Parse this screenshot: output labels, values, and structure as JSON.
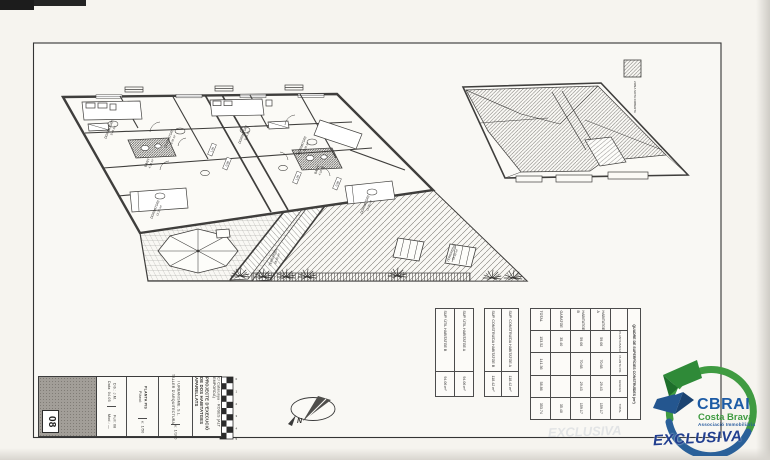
{
  "sheet": {
    "number": "08",
    "project_title": "PROJECTE D'EXECUCIÓ DE DOS HABITATGES APARELLATS",
    "project_address": "C/ Catalunya · ROSES (ALT EMPORDÀ)",
    "firm_line1": "TALLER D'ARQUITECTURA",
    "firm_line2": "I URBANISME, S.L.",
    "drawing_label": "Plànol:",
    "drawing_name": "PLANTA PIS",
    "scale_a": "e: 1/50",
    "scale_b": "e: 1/100",
    "rev": [
      "Data: 04.05",
      "Dib.: J.M.",
      "Mod.: —",
      "Full: 08"
    ]
  },
  "legend": {
    "label": "ZONA SOTA COBERTA"
  },
  "north": {
    "label": "N"
  },
  "scale_bar": {
    "ticks": [
      "0",
      "1",
      "2",
      "3",
      "4",
      "5"
    ]
  },
  "rooms": [
    {
      "name": "DORMITORI",
      "area": "9.45 m²"
    },
    {
      "name": "DORMITORI",
      "area": "8.70 m²"
    },
    {
      "name": "BANY",
      "area": "4.10 m²"
    },
    {
      "name": "DORMITORI",
      "area": "12.35 m²"
    },
    {
      "name": "DORMITORI",
      "area": "9.45 m²"
    },
    {
      "name": "DORMITORI",
      "area": "8.70 m²"
    },
    {
      "name": "BANY",
      "area": "4.10 m²"
    },
    {
      "name": "DORMITORI",
      "area": "12.35 m²"
    },
    {
      "name": "TERRASSA",
      "area": "28.40 m²"
    },
    {
      "name": "TERRASSA",
      "area": "28.40 m²"
    }
  ],
  "dim_tags": [
    "1.05",
    "0.90",
    "1.05",
    "0.90"
  ],
  "tables": {
    "useful": {
      "rows": [
        {
          "label": "SUP. ÚTIL HABITATGE A",
          "value": "94.06 m²"
        },
        {
          "label": "SUP. ÚTIL HABITATGE B",
          "value": "94.06 m²"
        }
      ]
    },
    "built": {
      "rows": [
        {
          "label": "SUP. CONSTRUÏDA HABITATGE A",
          "value": "118.42 m²"
        },
        {
          "label": "SUP. CONSTRUÏDA HABITATGE B",
          "value": "118.42 m²"
        }
      ]
    },
    "summary": {
      "title": "QUADRE DE SUPERFÍCIES CONSTRUÏDES (m²)",
      "col_headers": [
        "",
        "PLANTA BAIXA",
        "PLANTA PIS",
        "GOLFES",
        "TOTAL"
      ],
      "rows": [
        [
          "HABITATGE A",
          "59.06",
          "70.68",
          "29.43",
          "159.17"
        ],
        [
          "HABITATGE B",
          "59.06",
          "70.68",
          "29.43",
          "159.17"
        ],
        [
          "GARATGE",
          "35.40",
          "",
          "",
          "35.40"
        ],
        [
          "TOTAL",
          "153.52",
          "141.36",
          "58.86",
          "353.74"
        ]
      ]
    }
  },
  "logo": {
    "brand": "CBRAI",
    "brand_sub": "Costa Brava",
    "brand_sub2": "Associació Immobiliària",
    "banner": "EXCLUSIVA",
    "watermark": "EXCLUSIVA",
    "colors": {
      "green": "#3f9b41",
      "blue": "#2a6099",
      "navy": "#223f8f"
    }
  }
}
